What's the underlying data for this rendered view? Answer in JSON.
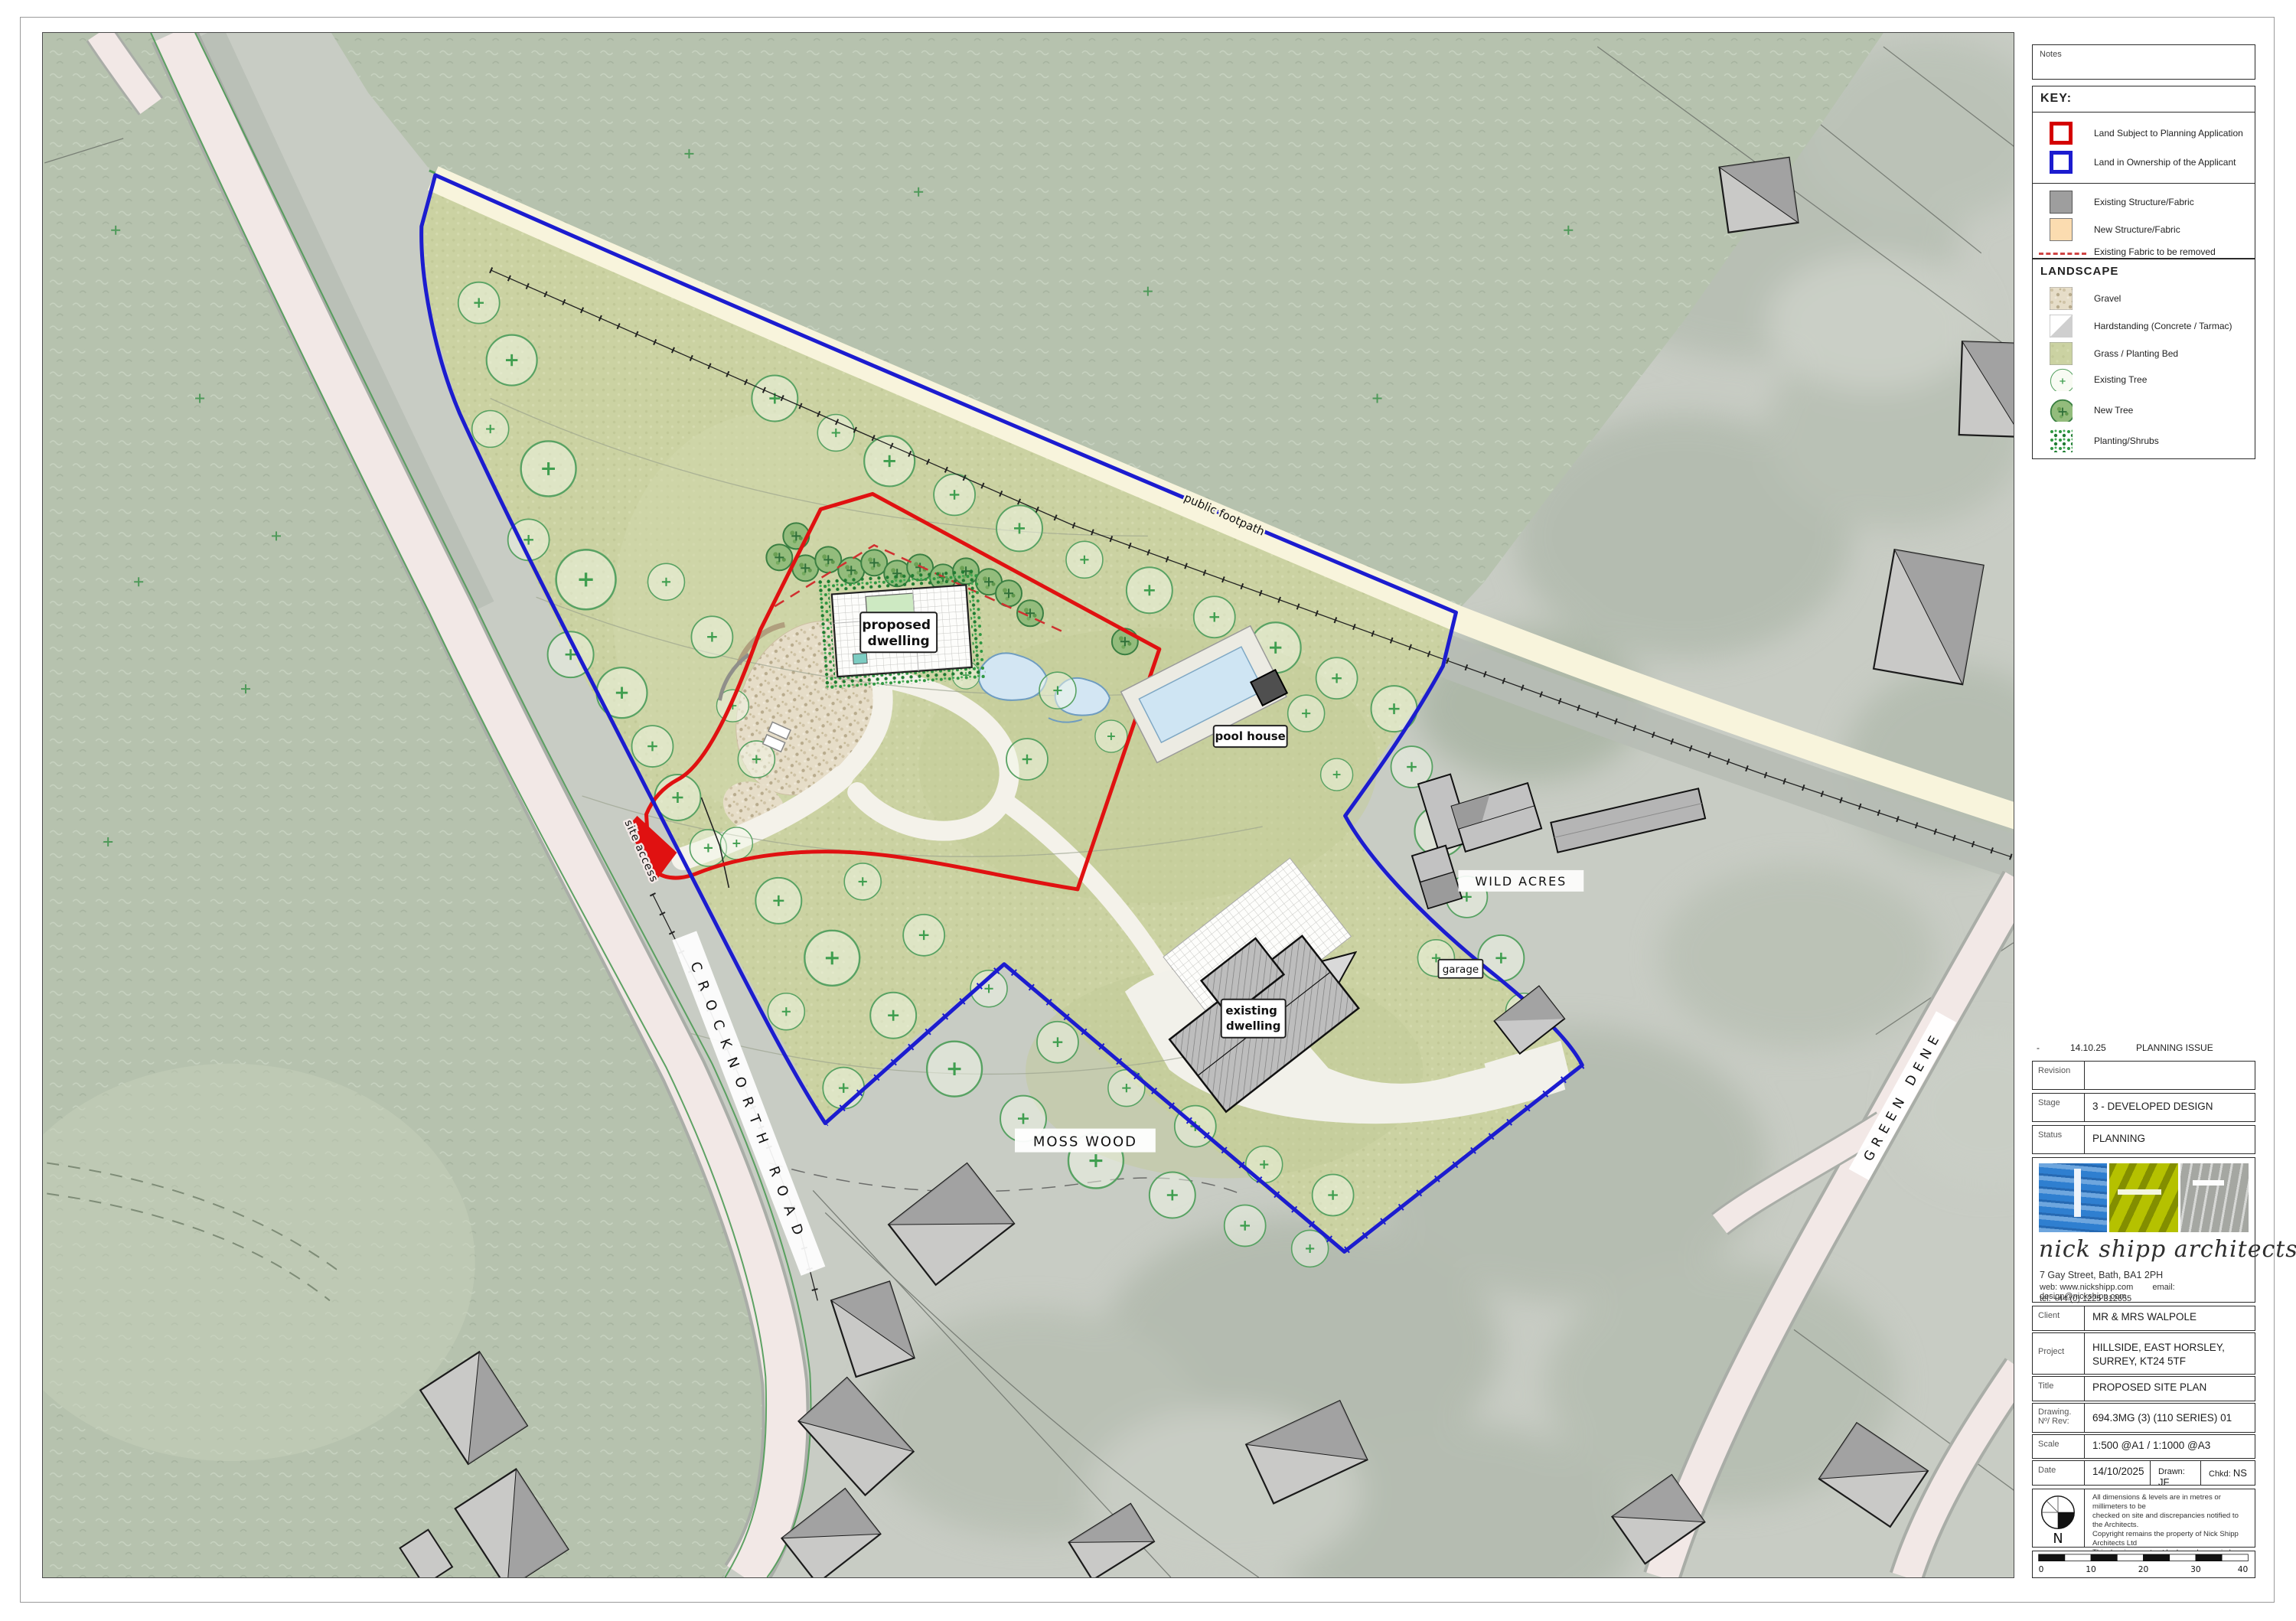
{
  "sheet": {
    "notes_label": "Notes"
  },
  "key": {
    "title": "KEY:",
    "items": [
      {
        "label": "Land Subject to Planning Application"
      },
      {
        "label": "Land in Ownership of the Applicant"
      },
      {
        "label": "Existing Structure/Fabric"
      },
      {
        "label": "New Structure/Fabric"
      },
      {
        "label": "Existing Fabric to be removed"
      }
    ]
  },
  "landscape": {
    "title": "LANDSCAPE",
    "items": [
      {
        "label": "Gravel"
      },
      {
        "label": "Hardstanding (Concrete / Tarmac)"
      },
      {
        "label": "Grass / Planting Bed"
      },
      {
        "label": "Existing Tree"
      },
      {
        "label": "New Tree"
      },
      {
        "label": "Planting/Shrubs"
      }
    ]
  },
  "map": {
    "labels": {
      "public_footpath": "public footpath",
      "site_access": "site access",
      "crocknorth_road": "CROCKNORTH ROAD",
      "green_dene": "GREEN DENE",
      "wild_acres": "WILD ACRES",
      "moss_wood": "MOSS WOOD",
      "garage": "garage",
      "pool_house": "pool house",
      "proposed_line1": "proposed",
      "proposed_line2": "dwelling",
      "existing_line1": "existing",
      "existing_line2": "dwelling"
    },
    "colors": {
      "planning_boundary_red": "#e01111",
      "ownership_boundary_blue": "#1c1ccf",
      "existing_structure_gray": "#9e9e9e",
      "new_structure_peach": "#fbdcb0",
      "grass_green": "#cbd2a2",
      "road_pink": "#f2e8e6",
      "footpath_cream": "#f8f4dc"
    }
  },
  "revision_note": {
    "rev": "-",
    "date": "14.10.25",
    "desc": "PLANNING ISSUE"
  },
  "title_block": {
    "revision_label": "Revision",
    "revision_value": "",
    "stage_label": "Stage",
    "stage_value": "3 - DEVELOPED DESIGN",
    "status_label": "Status",
    "status_value": "PLANNING",
    "client_label": "Client",
    "client_value": "MR & MRS WALPOLE",
    "project_label": "Project",
    "project_value": "HILLSIDE, EAST HORSLEY, SURREY, KT24 5TF",
    "title_label": "Title",
    "title_value": "PROPOSED SITE PLAN",
    "drawing_label": "Drawing. Nº/ Rev:",
    "drawing_value": "694.3MG (3) (110 SERIES) 01",
    "scale_label": "Scale",
    "scale_value": "1:500 @A1 / 1:1000 @A3",
    "date_label": "Date",
    "date_value": "14/10/2025",
    "drawn_label": "Drawn:",
    "drawn_value": "JF",
    "chkd_label": "Chkd:",
    "chkd_value": "NS"
  },
  "firm": {
    "name": "nick shipp architects",
    "address": "7 Gay Street, Bath, BA1 2PH",
    "web_label": "web:",
    "web": "www.nickshipp.com",
    "email_label": "email:",
    "email": "design@nickshipp.com",
    "tel": "tel: +44 (0) 1225 312655"
  },
  "disclaimer": {
    "lines": [
      "All dimensions & levels are in metres or millimeters to be",
      "checked on site and discrepancies notified to the Architects.",
      "Copyright remains the property of Nick Shipp Architects Ltd",
      "This drawing must not be loaned or copied",
      "to third parties without express prior written agreement."
    ]
  },
  "north": {
    "letter": "N"
  },
  "scale_bar": {
    "ticks": [
      "0",
      "10",
      "20",
      "30",
      "40"
    ]
  }
}
